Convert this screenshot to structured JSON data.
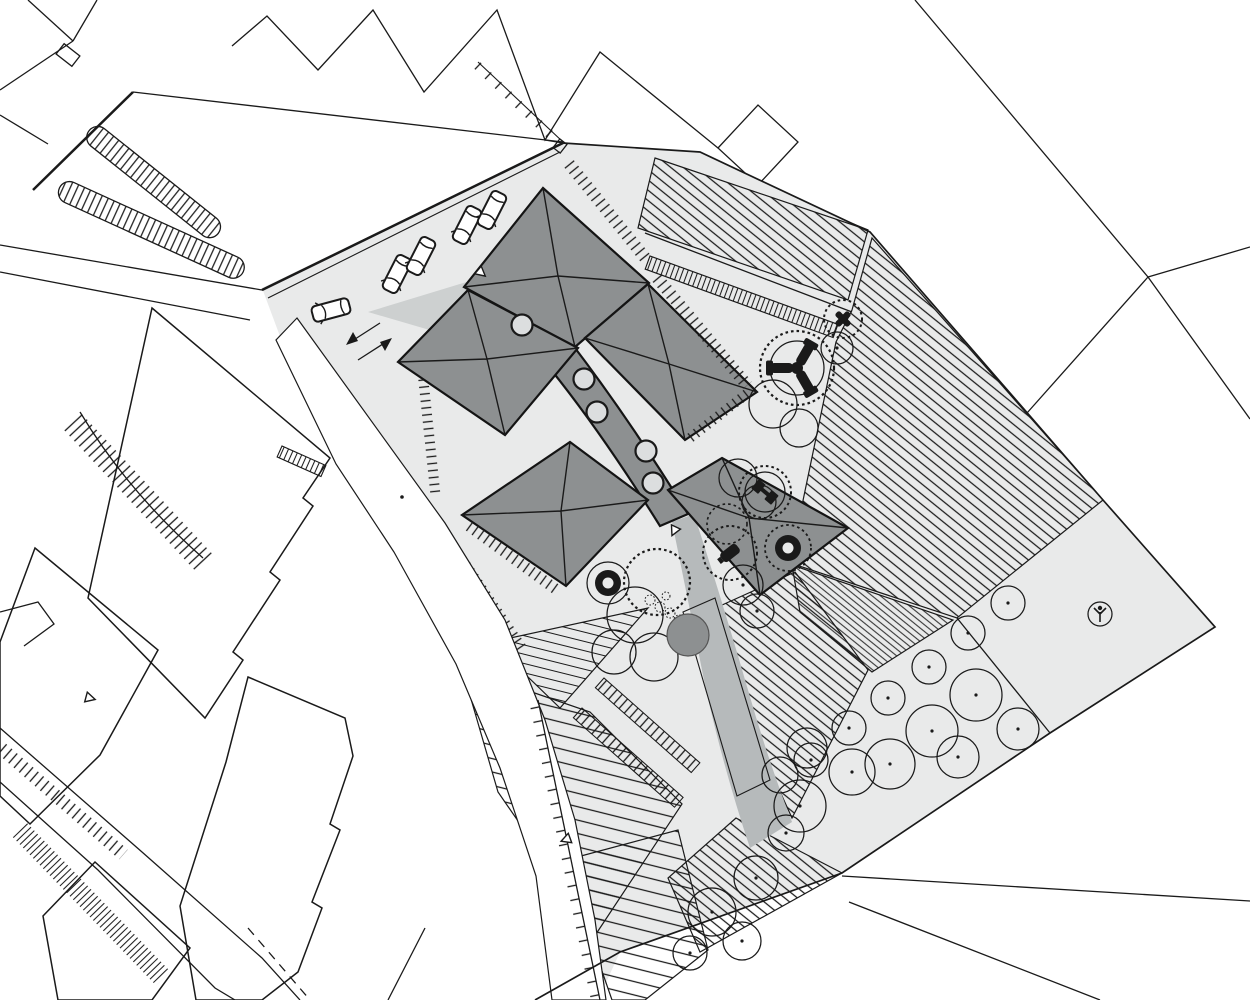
{
  "meta": {
    "title": "Architectural site plan drawing",
    "description": "Black and white masterplan: pinwheel-roofed building group with parking court, playground circles, cultivated field strips and an orchard of trees, surrounded by line-drawn context buildings and roads"
  },
  "colors": {
    "background": "#ffffff",
    "site": "#e9eaea",
    "roof": "#8d9091",
    "roof_light": "#dcdedf",
    "path": "#b6babb",
    "entry_wedge": "#cdd0d0",
    "line": "#1a1a1a"
  },
  "inventory": {
    "parked_cars": 5,
    "roof_skylights": 5,
    "orchard_trees": 20,
    "playground_features": 12,
    "hatched_fields": 8,
    "context_buildings": 7
  }
}
